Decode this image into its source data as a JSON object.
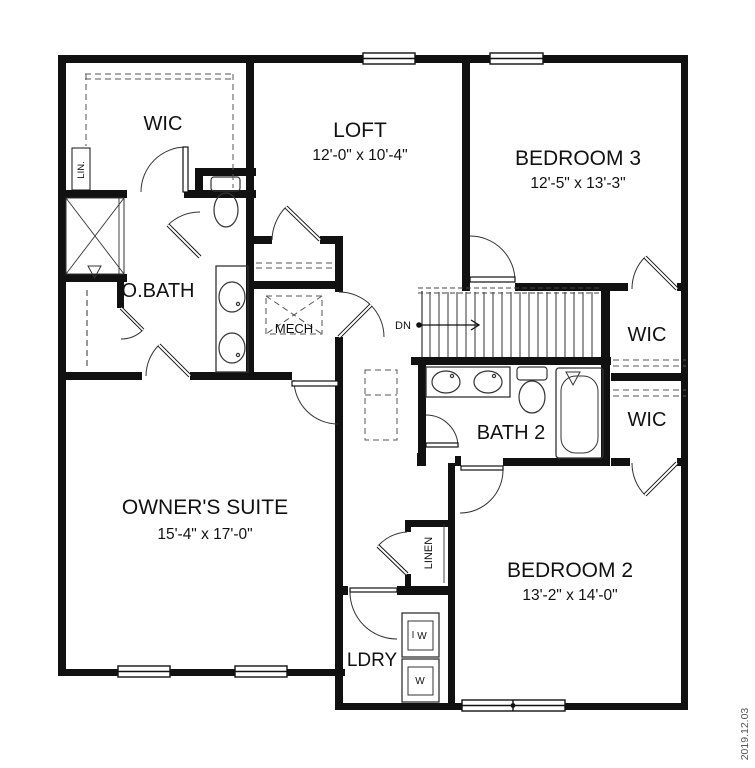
{
  "plan": {
    "rooms": {
      "wic_master": {
        "label": "WIC"
      },
      "lin_closet": {
        "label": "LIN."
      },
      "obath": {
        "label": "O.BATH"
      },
      "loft": {
        "label": "LOFT",
        "dims": "12'-0\" x 10'-4\""
      },
      "bedroom3": {
        "label": "BEDROOM 3",
        "dims": "12'-5\" x 13'-3\""
      },
      "mech": {
        "label": "MECH"
      },
      "stairs": {
        "direction_label": "DN"
      },
      "wic_bed3": {
        "label": "WIC"
      },
      "wic_bed2": {
        "label": "WIC"
      },
      "bath2": {
        "label": "BATH 2"
      },
      "owners_suite": {
        "label": "OWNER'S SUITE",
        "dims": "15'-4\" x 17'-0\""
      },
      "bedroom2": {
        "label": "BEDROOM 2",
        "dims": "13'-2\" x 14'-0\""
      },
      "linen": {
        "label": "LINEN"
      },
      "ldry": {
        "label": "LDRY"
      },
      "washer": {
        "label": "W"
      },
      "dryer": {
        "label": "W"
      }
    },
    "annotations": {
      "date": "2019.12.03"
    },
    "colors": {
      "wall": "#111111",
      "background": "#ffffff",
      "dashed": "#555555",
      "date_text": "#555555"
    }
  }
}
